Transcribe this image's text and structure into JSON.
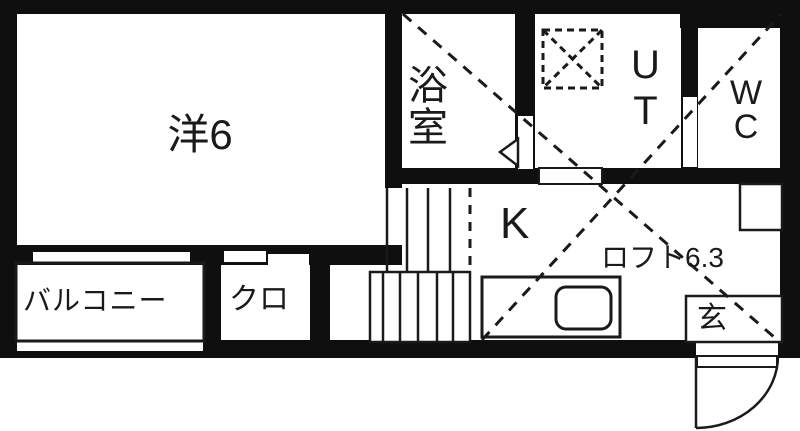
{
  "floorplan": {
    "title": "apartment-floor-plan",
    "rooms": {
      "western_room": {
        "label": "洋6"
      },
      "bathroom": {
        "label": "浴\n室"
      },
      "utility": {
        "label": "U\nT"
      },
      "toilet": {
        "label": "W\nC"
      },
      "kitchen": {
        "label": "K"
      },
      "loft": {
        "label": "ロフト6.3"
      },
      "balcony": {
        "label": "バルコニー"
      },
      "closet": {
        "label": "クロ"
      },
      "entrance": {
        "label": "玄"
      }
    },
    "symbols": {
      "washing_machine": "dashed-square-x",
      "entrance_door": "quarter-arc-swing",
      "stairs": "tread-lines",
      "loft_area": "dashed-x-cross"
    },
    "colors": {
      "wall": "#0f0f0f",
      "line": "#1a1a1a",
      "background": "#ffffff"
    }
  }
}
